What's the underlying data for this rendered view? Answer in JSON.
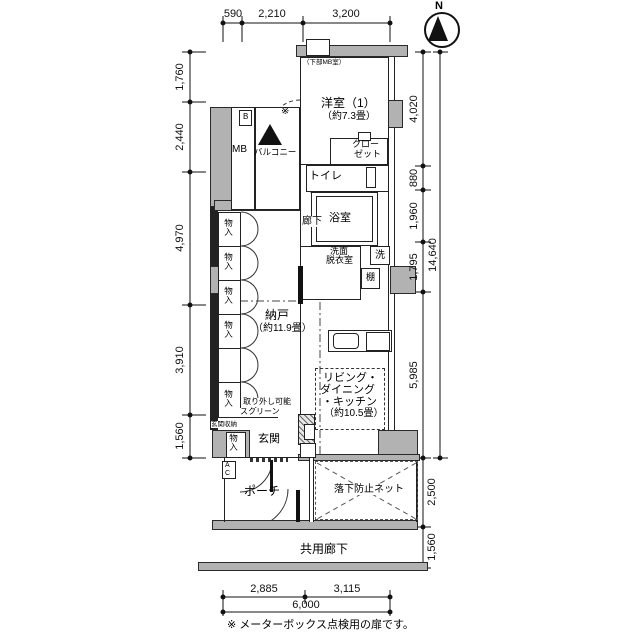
{
  "compass": {
    "label": "N"
  },
  "dimensions": {
    "top": [
      "590",
      "2,210",
      "3,200"
    ],
    "left": [
      "1,760",
      "2,440",
      "4,970",
      "3,910",
      "1,560"
    ],
    "right": [
      "4,020",
      "880",
      "1,960",
      "1,795",
      "5,985"
    ],
    "right_total": "14,640",
    "right_below": [
      "2,500",
      "1,560"
    ],
    "bottom": [
      "2,885",
      "3,115"
    ],
    "bottom_total": "6,000"
  },
  "rooms": {
    "western_room": {
      "name": "洋室（1）",
      "size": "（約7.3畳）"
    },
    "closet": {
      "line1": "クロー",
      "line2": "ゼット"
    },
    "toilet": {
      "name": "トイレ"
    },
    "bath": {
      "name": "浴室"
    },
    "hallway": {
      "name": "廊下"
    },
    "washroom": {
      "line1": "洗面",
      "line2": "脱衣室"
    },
    "washer": {
      "name": "洗"
    },
    "shelf": {
      "name": "棚"
    },
    "storage_room": {
      "name": "納戸",
      "size": "（約11.9畳）"
    },
    "ldk": {
      "line1": "リビング・",
      "line2": "ダイニング",
      "line3": "・キッチン",
      "size": "（約10.5畳）"
    },
    "entrance": {
      "name": "玄関"
    },
    "entrance_storage": {
      "name": "玄関収納"
    },
    "closet_small": {
      "name": "物入"
    },
    "balcony": {
      "name": "バルコニー"
    },
    "meter_box": {
      "name": "MB"
    },
    "b_box": {
      "name": "B"
    },
    "ac_unit": {
      "a": "A",
      "c": "C"
    },
    "porch": {
      "name": "ポーチ"
    },
    "net": {
      "name": "落下防止ネット"
    },
    "common_corridor": {
      "name": "共用廊下"
    }
  },
  "annotations": {
    "under_window": "（下部MB室）",
    "screen_line1": "取り外し可能",
    "screen_line2": "スクリーン",
    "door_mark": "※",
    "note": "※ メーターボックス点検用の扉です。"
  }
}
